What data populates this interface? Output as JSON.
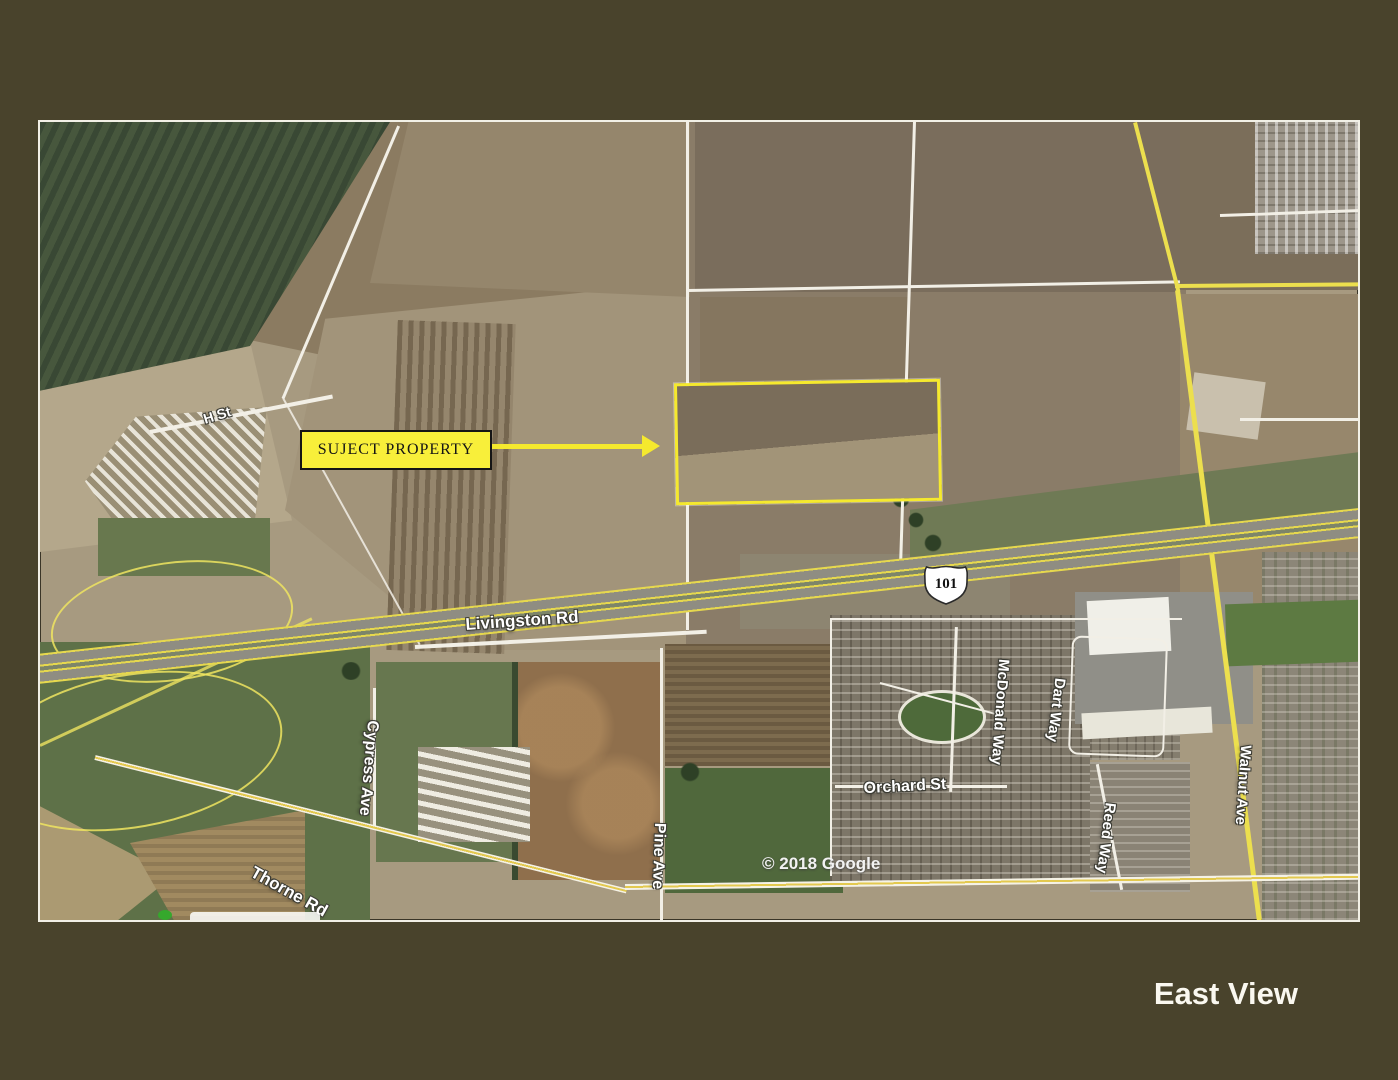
{
  "slide": {
    "title": "East View"
  },
  "map": {
    "attribution": "© 2018 Google",
    "shield": {
      "route": "101"
    },
    "callout": {
      "label": "SUJECT PROPERTY"
    },
    "labels": {
      "h_st": "H St",
      "livingston": "Livingston Rd",
      "cypress": "Cypress Ave",
      "thorne": "Thorne Rd",
      "pine": "Pine Ave",
      "orchard": "Orchard St",
      "mcdonald": "McDonald Way",
      "dart": "Dart Way",
      "reed": "Reed Way",
      "walnut": "Walnut Ave"
    },
    "colors": {
      "slide_background": "#49432c",
      "callout_yellow": "#f8ef3a",
      "property_outline_yellow": "#f5e92e",
      "road_yellow": "#ecdf4e",
      "label_text": "#ffffff",
      "attribution_text": "#f2f2f2",
      "title_text": "#faf8f0"
    }
  }
}
